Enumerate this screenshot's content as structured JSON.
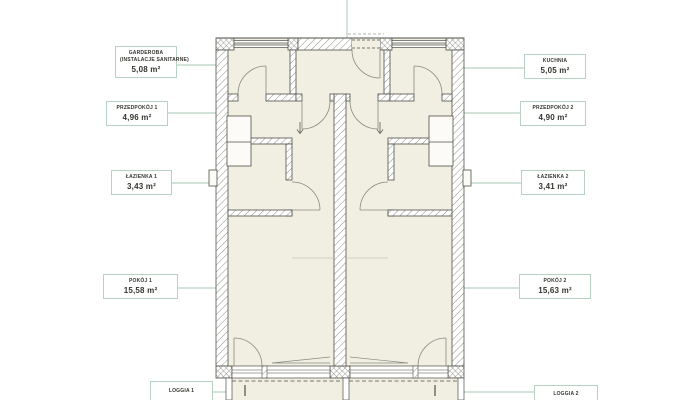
{
  "title": "apartment-floor-plan",
  "labels": {
    "garderoba": {
      "line1": "GARDEROBA",
      "line2": "(INSTALACJE SANITARNE)",
      "area": "5,08 m²"
    },
    "przedpokoj1": {
      "line1": "PRZEDPOKÓJ 1",
      "area": "4,96 m²"
    },
    "lazienka1": {
      "line1": "ŁAZIENKA 1",
      "area": "3,43 m²"
    },
    "pokoj1": {
      "line1": "POKÓJ 1",
      "area": "15,58 m²"
    },
    "loggia1": {
      "line1": "LOGGIA 1"
    },
    "kuchnia": {
      "line1": "KUCHNIA",
      "area": "5,05 m²"
    },
    "przedpokoj2": {
      "line1": "PRZEDPOKÓJ 2",
      "area": "4,90 m²"
    },
    "lazienka2": {
      "line1": "ŁAZIENKA 2",
      "area": "3,41 m²"
    },
    "pokoj2": {
      "line1": "POKÓJ 2",
      "area": "15,63 m²"
    },
    "loggia2": {
      "line1": "LOGGIA 2"
    }
  },
  "colors": {
    "leader_line": "#b7d2c3",
    "label_border": "#b7d2c3",
    "room_fill": "#f1efe2",
    "wall_outline": "#4f4f48",
    "hatch_line": "#8f8f87",
    "text": "#35352f"
  }
}
